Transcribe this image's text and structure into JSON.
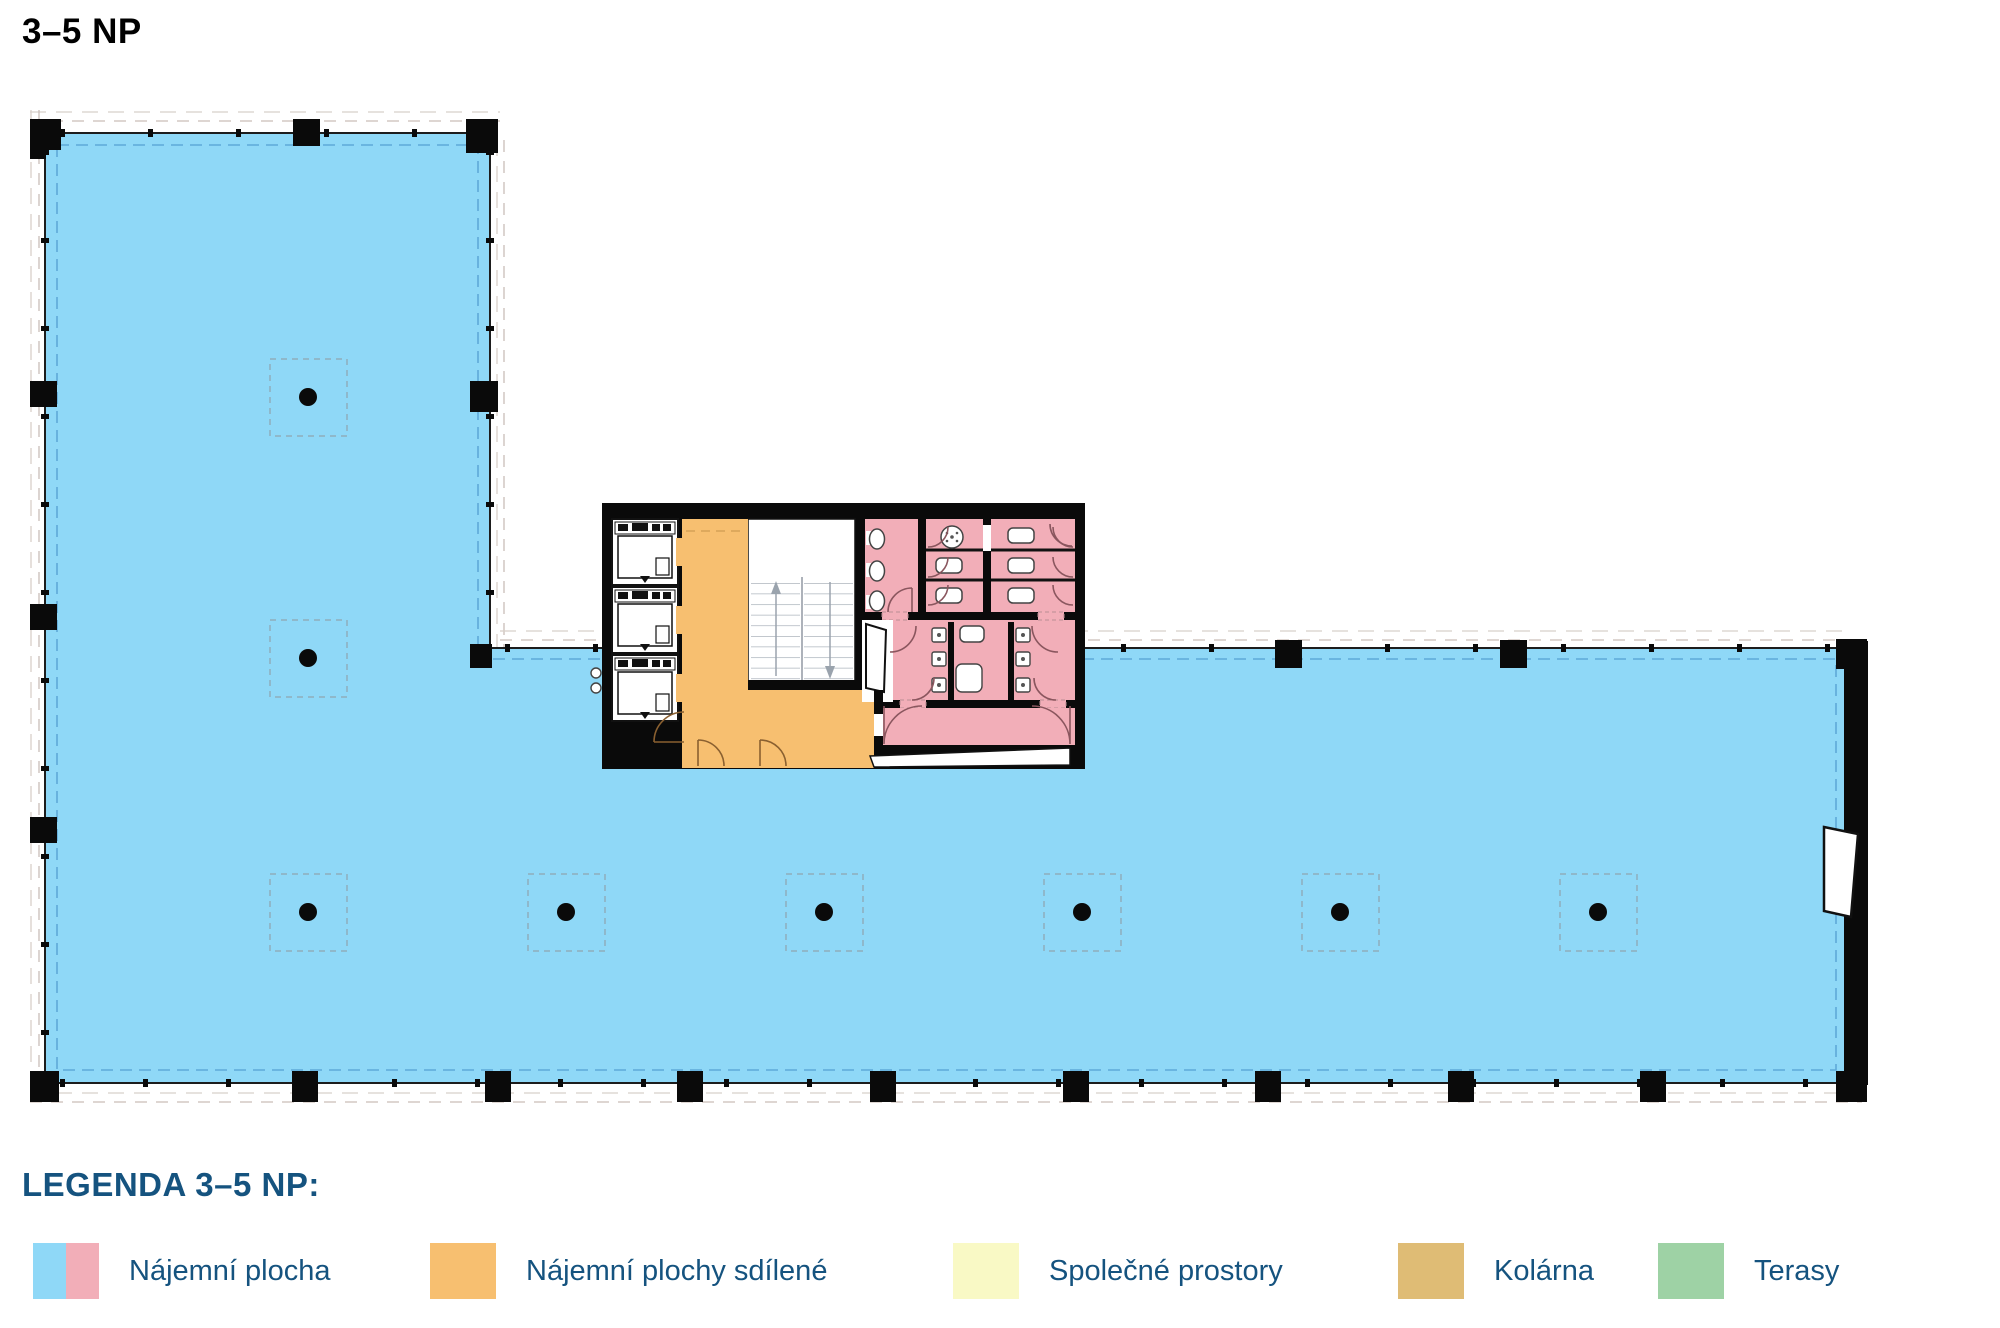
{
  "page": {
    "title": "3–5 NP"
  },
  "legend": {
    "heading": "LEGENDA 3–5 NP:",
    "items": [
      {
        "label": "Nájemní plocha",
        "colors": [
          "#8fd8f7",
          "#f2aeb8"
        ]
      },
      {
        "label": "Nájemní plochy sdílené",
        "colors": [
          "#f7bf70"
        ]
      },
      {
        "label": "Společné prostory",
        "colors": [
          "#f9f9c5"
        ]
      },
      {
        "label": "Kolárna",
        "colors": [
          "#dfbc75"
        ]
      },
      {
        "label": "Terasy",
        "colors": [
          "#9ed2a5"
        ]
      }
    ]
  },
  "colors": {
    "heading_blue": "#15537f",
    "rental_blue": "#8fd8f7",
    "rental_pink": "#f2aeb8",
    "shared_orange": "#f7bf70",
    "common_yellow": "#f9f9c5",
    "bike_tan": "#dfbc75",
    "terrace_green": "#9ed2a5",
    "wall_black": "#0a0a0a"
  },
  "plan": {
    "floor": "3–5 NP",
    "areas": [
      {
        "name": "rental-area-left-wing",
        "type": "Nájemní plocha"
      },
      {
        "name": "rental-area-south-strip",
        "type": "Nájemní plocha"
      },
      {
        "name": "shared-lobby",
        "type": "Nájemní plochy sdílené"
      },
      {
        "name": "sanitary-block",
        "type": "Nájemní plocha (hyg. zázemí)"
      },
      {
        "name": "elevators",
        "count": 3
      },
      {
        "name": "staircase",
        "count": 1
      }
    ]
  }
}
